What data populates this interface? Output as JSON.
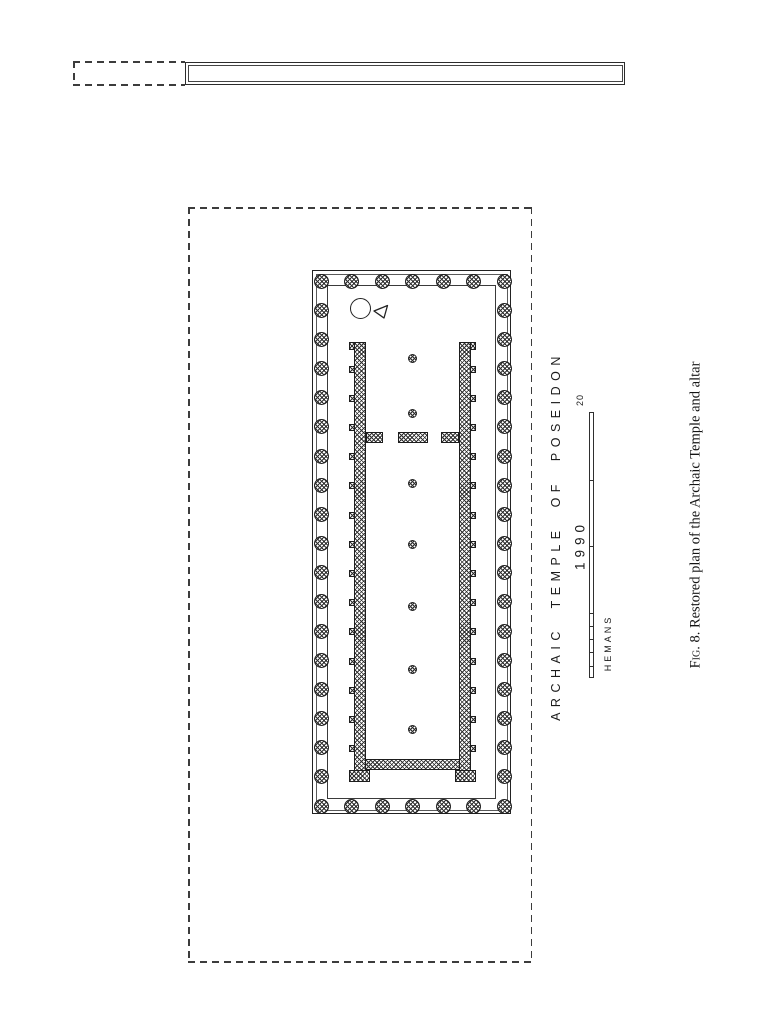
{
  "texts": {
    "title": "ARCHAIC TEMPLE OF POSEIDON",
    "year": "1990",
    "scale_max": "20",
    "credit": "HEMANS",
    "caption_fig": "Fig. 8.",
    "caption_text": " Restored plan of the Archaic Temple and altar"
  },
  "colors": {
    "ink": "#222222",
    "paper": "#ffffff"
  },
  "plan_geometry": {
    "precinct": {
      "x": 188,
      "y": 207,
      "w": 344,
      "h": 756
    },
    "altar_dashed": {
      "x": 73,
      "y": 61,
      "w": 112,
      "h": 24
    },
    "altar_solid": {
      "x": 185,
      "y": 62,
      "w": 440,
      "h": 23
    },
    "peristyle": {
      "end_count": 7,
      "flank_count": 19,
      "col_d": 15,
      "left_x": 8,
      "right_x": 191,
      "top_y": 10,
      "bottom_y": 535
    },
    "cella": {
      "wall_w": 12,
      "left_x": 41,
      "right_x": 146,
      "top_y": 71,
      "bottom_y": 511,
      "buttress_count": 14,
      "buttress_first_y": 98,
      "buttress_step": 29.2,
      "buttress_w": 5,
      "buttress_h": 7,
      "anta_tab_h": 8,
      "partition": {
        "y": 161,
        "h": 11,
        "left_spur_x": 53,
        "left_spur_w": 17,
        "center_x": 85,
        "center_w": 30,
        "right_spur_x": 128,
        "right_spur_w": 18
      },
      "rear_wall": {
        "y": 488,
        "h": 11
      },
      "foot": {
        "y": 499,
        "h": 12,
        "w": 21
      },
      "axial_x": 99.5,
      "axial_d": 9,
      "axial_ys": [
        87,
        142,
        212,
        273,
        335,
        398,
        458
      ]
    },
    "scalebar": {
      "h": 266,
      "major_divs": 4,
      "minor_divs": 5
    }
  }
}
